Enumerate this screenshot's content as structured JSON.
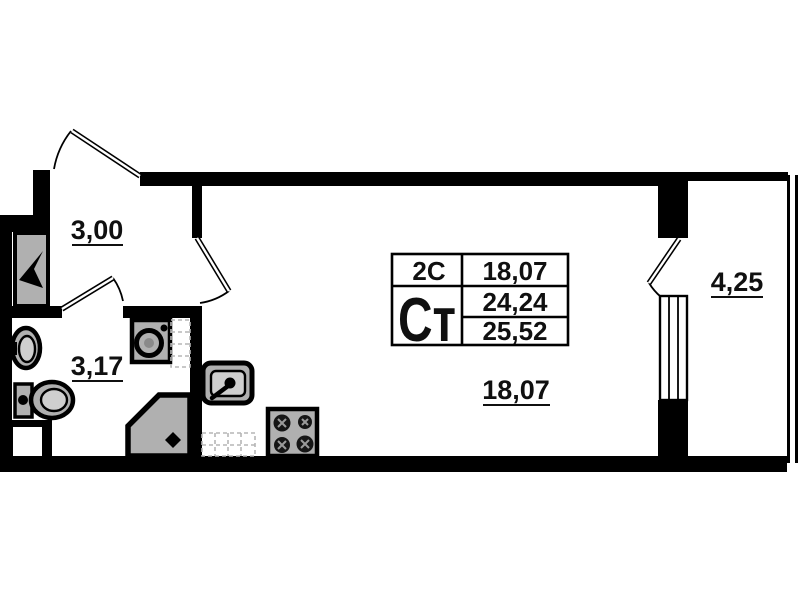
{
  "colors": {
    "wall": "#000000",
    "background": "#ffffff",
    "fixture_fill": "#b0b0b0"
  },
  "floor_plan": {
    "rooms": [
      {
        "name": "hallway",
        "area": "3,00"
      },
      {
        "name": "bathroom",
        "area": "3,17"
      },
      {
        "name": "main-room",
        "area": "18,07"
      },
      {
        "name": "balcony",
        "area": "4,25"
      }
    ],
    "info_table": {
      "apartment_type_short": "2С",
      "apartment_type": "Ст",
      "living_area": "18,07",
      "area_no_balcony": "24,24",
      "total_area": "25,52"
    },
    "fixtures": [
      "wardrobe",
      "washbasin",
      "toilet",
      "washing-machine",
      "shower",
      "kitchen-sink",
      "stove",
      "counter",
      "window",
      "balcony-door",
      "entrance-door"
    ]
  }
}
